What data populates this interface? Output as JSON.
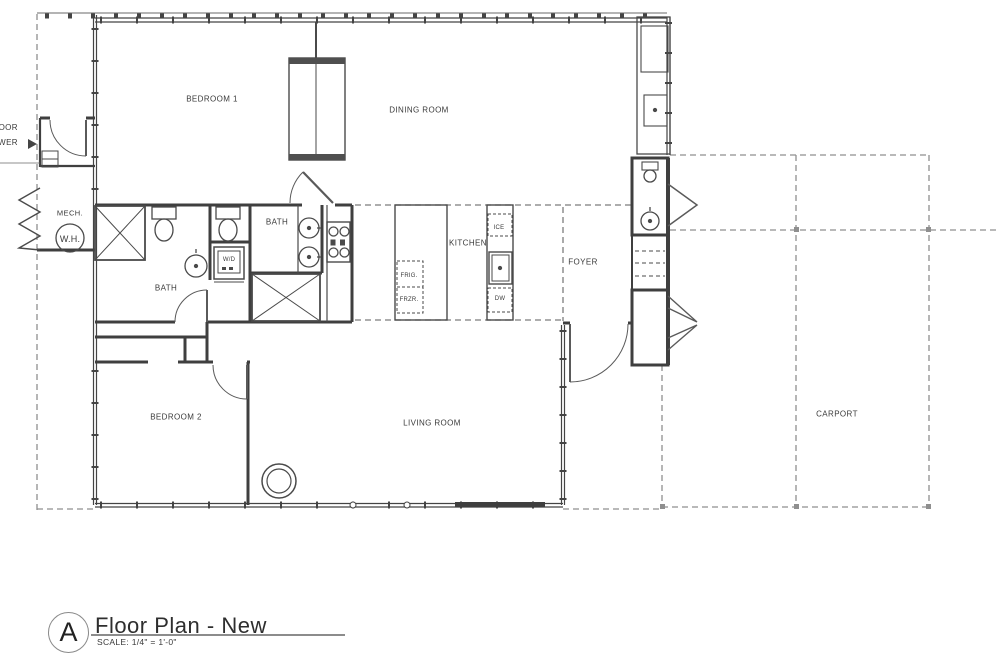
{
  "floor_plan": {
    "rooms": {
      "bedroom1": "BEDROOM 1",
      "dining": "DINING ROOM",
      "bath_hall": "BATH",
      "bath_master": "BATH",
      "kitchen": "KITCHEN",
      "foyer": "FOYER",
      "bedroom2": "BEDROOM 2",
      "living": "LIVING ROOM",
      "carport": "CARPORT",
      "mech": "MECH."
    },
    "fixtures": {
      "water_heater": "W.H.",
      "washer_dryer": "W/D",
      "ice": "ICE",
      "fridge": "FRIG.",
      "freezer": "FRZR.",
      "dishwasher": "DW"
    },
    "clipped_label": {
      "line1": "OOR",
      "line2": "WER"
    },
    "title_block": {
      "detail_letter": "A",
      "title": "Floor Plan - New",
      "scale": "SCALE: 1/4\" = 1'-0\""
    }
  },
  "colors": {
    "wall": "#3f3f3f",
    "dashed_roof": "#8f8f8f",
    "text": "#3a3a3a",
    "background": "#ffffff"
  }
}
